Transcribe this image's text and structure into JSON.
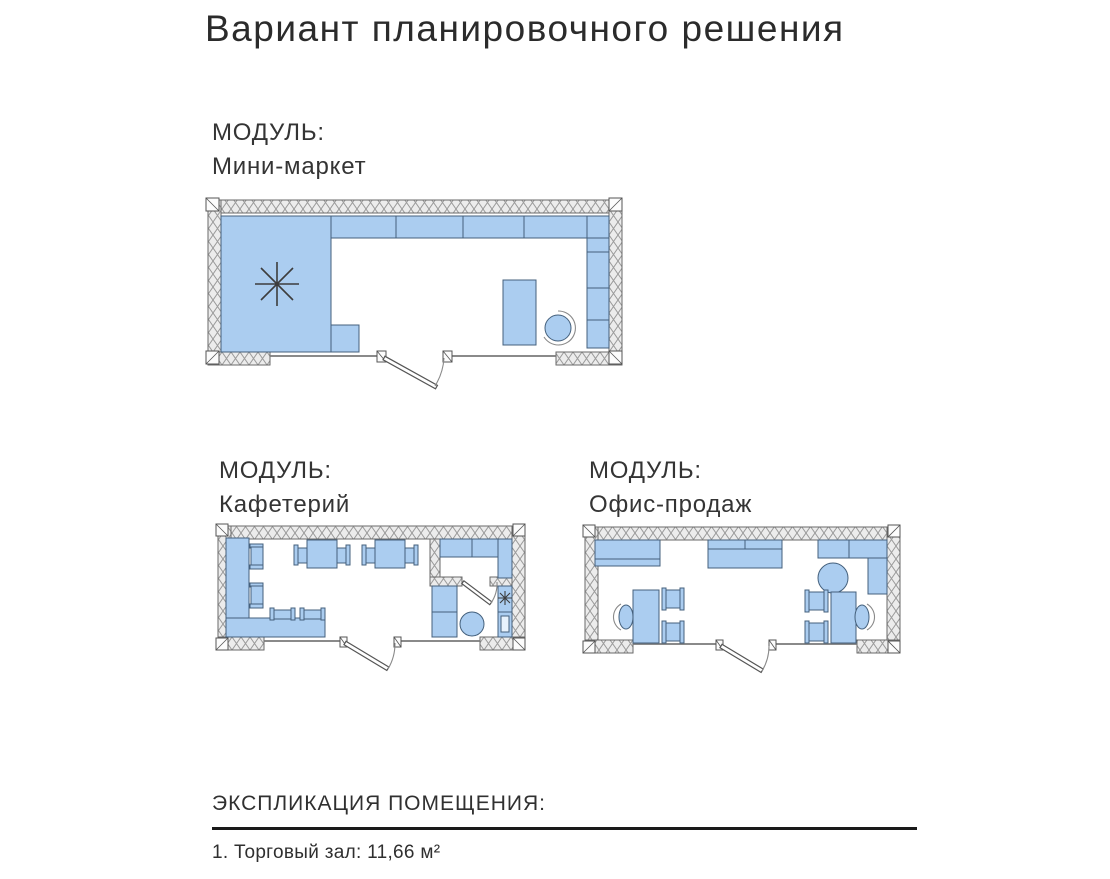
{
  "page": {
    "title": "Вариант планировочного решения"
  },
  "modules": [
    {
      "id": "mini-market",
      "label_prefix": "МОДУЛЬ:",
      "name": "Мини-маркет"
    },
    {
      "id": "cafeteria",
      "label_prefix": "МОДУЛЬ:",
      "name": "Кафетерий"
    },
    {
      "id": "sales-office",
      "label_prefix": "МОДУЛЬ:",
      "name": "Офис-продаж"
    }
  ],
  "explication": {
    "heading": "ЭКСПЛИКАЦИЯ ПОМЕЩЕНИЯ:",
    "items": [
      {
        "number": "1",
        "name": "Торговый зал",
        "area_m2": "11,66",
        "text": "1. Торговый зал: 11,66 м²"
      }
    ]
  },
  "colors": {
    "furniture_fill": "#abcdf0",
    "furniture_stroke": "#44607c",
    "wall_fill": "#ececec",
    "wall_hatch": "#9a9a9a",
    "text": "#333333",
    "title": "#2b2b2b",
    "line": "#1a1a1a"
  }
}
